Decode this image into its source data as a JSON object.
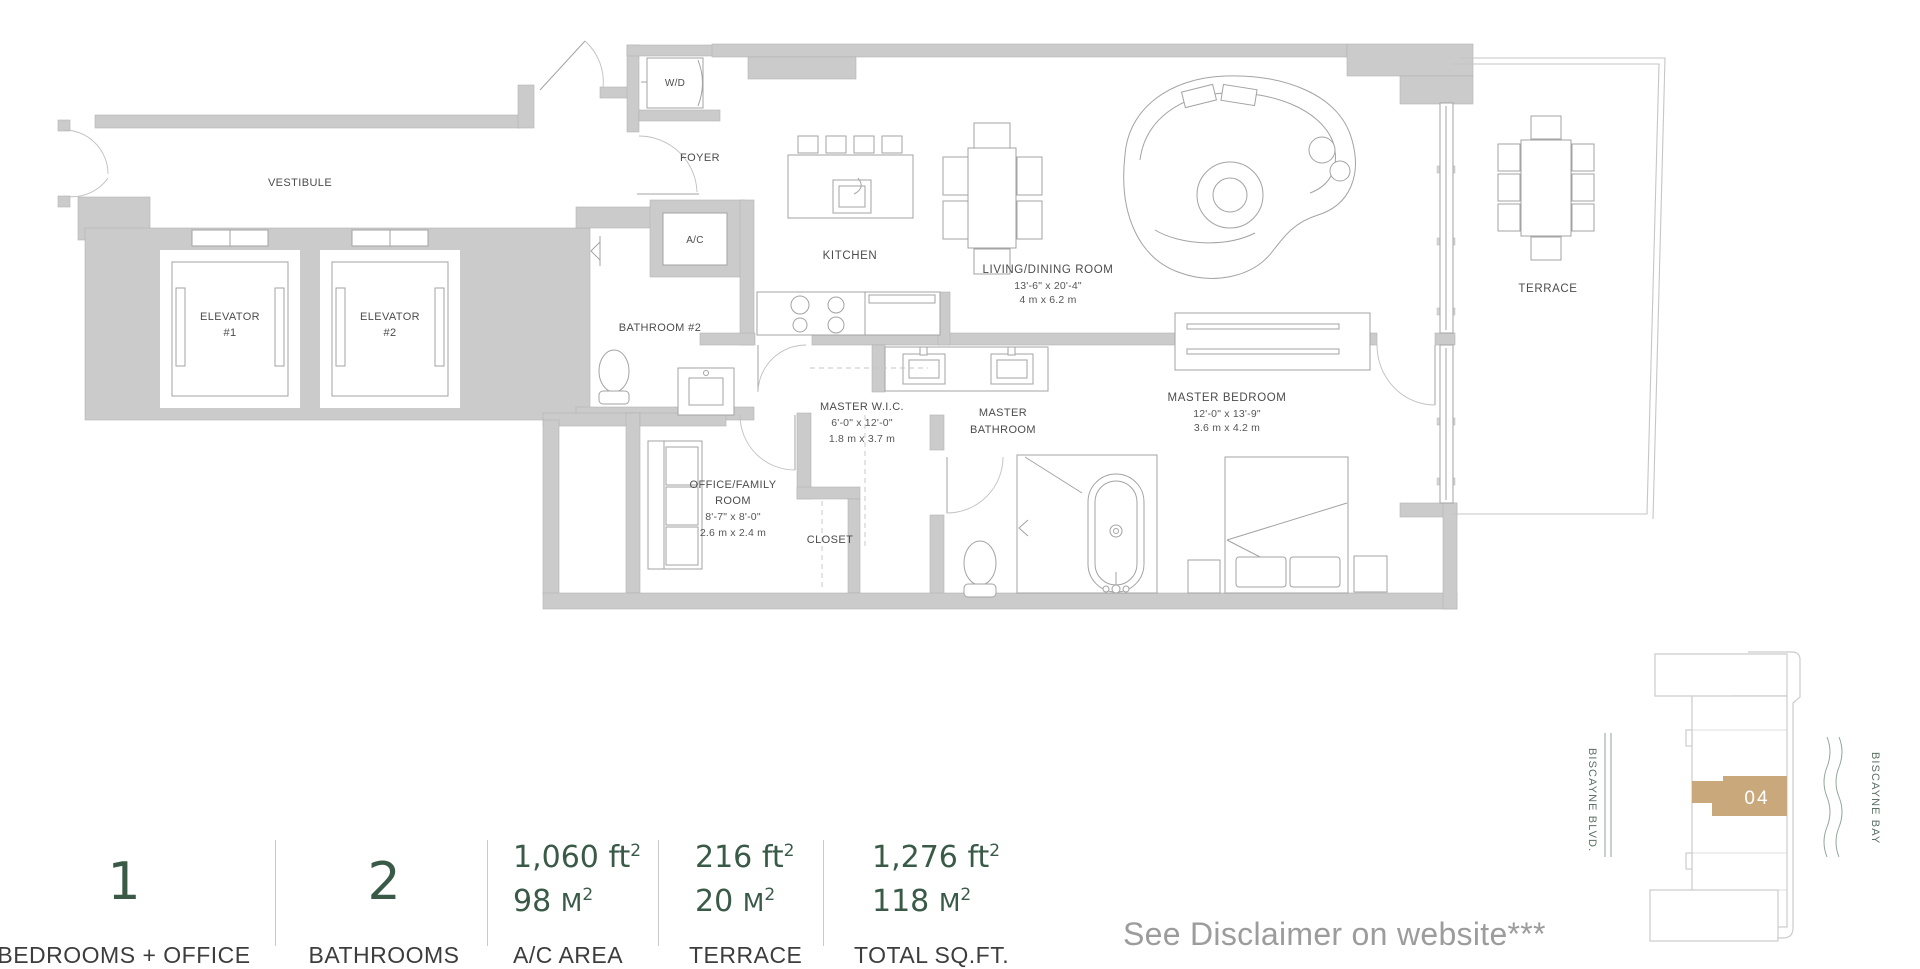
{
  "plan": {
    "rooms": {
      "vestibule": {
        "label": "VESTIBULE"
      },
      "elevator1": {
        "l1": "ELEVATOR",
        "l2": "#1"
      },
      "elevator2": {
        "l1": "ELEVATOR",
        "l2": "#2"
      },
      "wd": {
        "label": "W/D"
      },
      "foyer": {
        "label": "FOYER"
      },
      "ac": {
        "label": "A/C"
      },
      "bathroom2": {
        "label": "BATHROOM #2"
      },
      "kitchen": {
        "label": "KITCHEN"
      },
      "living": {
        "label": "LIVING/DINING ROOM",
        "dim_ft": "13'-6\" x 20'-4\"",
        "dim_m": "4 m x 6.2 m"
      },
      "terrace": {
        "label": "TERRACE"
      },
      "master_wic": {
        "label": "MASTER W.I.C.",
        "dim_ft": "6'-0\" x 12'-0\"",
        "dim_m": "1.8 m x 3.7 m"
      },
      "master_bath": {
        "l1": "MASTER",
        "l2": "BATHROOM"
      },
      "master_bedroom": {
        "label": "MASTER BEDROOM",
        "dim_ft": "12'-0\" x 13'-9\"",
        "dim_m": "3.6 m x 4.2 m"
      },
      "office": {
        "l1": "OFFICE/FAMILY",
        "l2": "ROOM",
        "dim_ft": "8'-7\" x 8'-0\"",
        "dim_m": "2.6 m x 2.4 m"
      },
      "closet": {
        "label": "CLOSET"
      }
    }
  },
  "stats": {
    "bedrooms": {
      "value": "1",
      "label": "BEDROOMS + OFFICE"
    },
    "bathrooms": {
      "value": "2",
      "label": "BATHROOMS"
    },
    "ac_area": {
      "ft_value": "1,060",
      "ft_unit": "ft",
      "ft_sup": "2",
      "m_value": "98",
      "m_unit": "M",
      "m_sup": "2",
      "label": "A/C AREA"
    },
    "terrace": {
      "ft_value": "216",
      "ft_unit": "ft",
      "ft_sup": "2",
      "m_value": "20",
      "m_unit": "M",
      "m_sup": "2",
      "label": "TERRACE"
    },
    "total": {
      "ft_value": "1,276",
      "ft_unit": "ft",
      "ft_sup": "2",
      "m_value": "118",
      "m_unit": "M",
      "m_sup": "2",
      "label": "TOTAL SQ.FT."
    }
  },
  "keyplan": {
    "unit": "04",
    "street": "BISCAYNE BLVD.",
    "bay": "BISCAYNE BAY"
  },
  "disclaimer": "See Disclaimer on website***",
  "colors": {
    "accent_green": "#3a5a48",
    "unit_tan": "#c9a97c",
    "wall_gray": "#cbcbcb",
    "label_gray": "#4c4c4c",
    "muted_gray": "#9c9c9c"
  }
}
